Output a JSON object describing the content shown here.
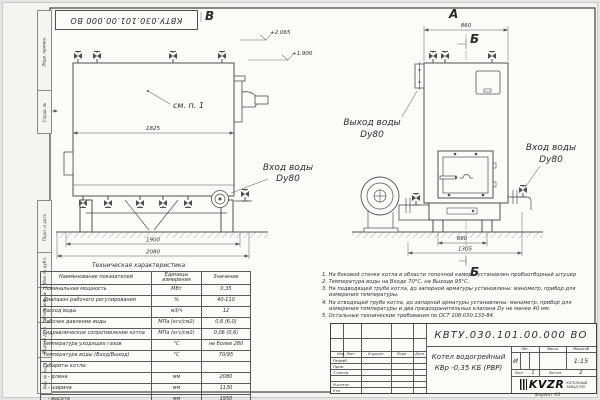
{
  "doc": {
    "number_top": "КВТУ.030.101.00.000 ВО",
    "format": "Формат А3"
  },
  "frame": {
    "side_labels": [
      "Перв. примен.",
      "Справ. №",
      "Подп. и дата",
      "Инв. № дубл.",
      "Взам. инв. №",
      "Подп. и дата",
      "Инв. № подл."
    ]
  },
  "views": {
    "left": {
      "section_label": "В",
      "arrow_label": "А",
      "note_ref": "см. п. 1",
      "dims": {
        "inner_width": "1825",
        "base": "1900",
        "overall": "2080"
      },
      "elevations": [
        "+2.065",
        "+1.900"
      ],
      "inlet": {
        "line1": "Вход воды",
        "line2": "Dy80"
      }
    },
    "right": {
      "view_label": "А",
      "section_top": "Б",
      "section_bottom": "Б",
      "dims": {
        "top": "860",
        "base": "660",
        "overall": "1305"
      },
      "outlet": {
        "line1": "Выход воды",
        "line2": "Dy80"
      },
      "inlet": {
        "line1": "Вход воды",
        "line2": "Dy80"
      }
    }
  },
  "spec_table": {
    "title": "Техническая характеристика",
    "col_headers": [
      "Наименование показателей",
      "Единицы измерения",
      "Значение"
    ],
    "rows": [
      {
        "name": "Номинальная мощность",
        "unit": "МВт",
        "value": "0,35"
      },
      {
        "name": "Диапазон рабочего регулирования",
        "unit": "%",
        "value": "40-110"
      },
      {
        "name": "Расход воды",
        "unit": "м3/ч",
        "value": "12"
      },
      {
        "name": "Рабочее давление воды",
        "unit": "МПа (кгс/см2)",
        "value": "0,6 (6,0)"
      },
      {
        "name": "Гидравлическое сопротивление котла",
        "unit": "МПа (кгс/см2)",
        "value": "0,06 (0,6)"
      },
      {
        "name": "Температура уходящих газов",
        "unit": "°С",
        "value": "не более 280"
      },
      {
        "name": "Температура воды (Вход/Выход)",
        "unit": "°С",
        "value": "70/95"
      },
      {
        "name": "Габариты котла:",
        "unit": "",
        "value": ""
      },
      {
        "name": "   - длина",
        "unit": "мм",
        "value": "2080"
      },
      {
        "name": "   - ширина",
        "unit": "мм",
        "value": "1130"
      },
      {
        "name": "   - высота",
        "unit": "мм",
        "value": "1950"
      }
    ]
  },
  "notes": [
    "1. На боковой стенке котла в области топочной камеры установлен пробоотборный штуцер",
    "2. Температура воды на Входе 70°С, на Выходе 95°С.",
    "3. На подводящей трубе котла, до запорной арматуры установлены: манометр, прибор для измерения температуры.",
    "4. На отводящей трубе котла, до запорной арматуры установлены: манометр, прибор для измерения температуры и два предохранительных клапана Dy не менее 40 мм.",
    "5. Остальные технические требования по ОСТ 108.030.133-84."
  ],
  "title_block": {
    "doc_number": "КВТУ.030.101.00.000 ВО",
    "product_title": "Котел водогрейный",
    "product_model": "КВр -0,35 КБ (РВР)",
    "header_cols": [
      "Изм. Лист",
      "N докум.",
      "Подп.",
      "Дата"
    ],
    "rows": [
      "Разраб.",
      "Пров.",
      "Т.контр.",
      "",
      "Н.контр.",
      "Утв."
    ],
    "lit_label": "Лит.",
    "mass_label": "Масса",
    "scale_label": "Масштаб",
    "lit_value": "И",
    "scale_value": "1:15",
    "sheet_label": "Лист",
    "sheet_value": "1",
    "sheets_label": "Листов",
    "sheets_value": "2",
    "company_logo": "KVZR",
    "company_name1": "КОТЕЛЬНЫЙ",
    "company_name2": "ЗАВОД РЭП"
  }
}
